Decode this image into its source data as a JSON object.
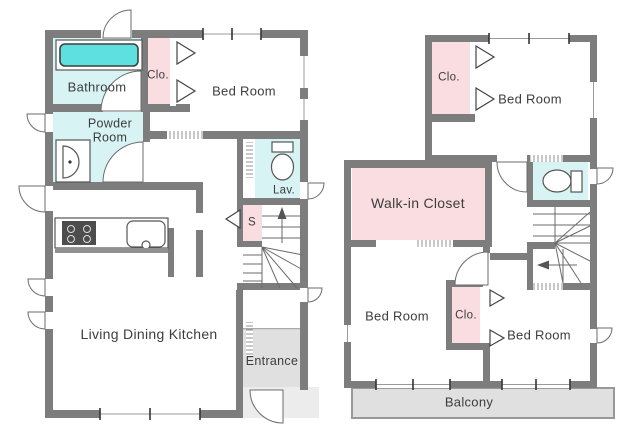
{
  "colors": {
    "wall": "#7d7d7d",
    "aqua": "#d8f3f3",
    "tub": "#5fe0e0",
    "pink": "#f9dde1",
    "roomgray": "#e0e0e0",
    "porchgray": "#ececec",
    "text": "#3d3d3d"
  },
  "floor1": {
    "rooms": {
      "bathroom": "Bathroom",
      "closet": "Clo.",
      "bedroom": "Bed Room",
      "powder_room": "Powder Room",
      "lavatory": "Lav.",
      "storage": "S",
      "living_dining_kitchen": "Living Dining Kitchen",
      "entrance": "Entrance"
    }
  },
  "floor2": {
    "rooms": {
      "closet_top": "Clo.",
      "bedroom_top": "Bed Room",
      "walk_in_closet": "Walk-in Closet",
      "bedroom_left": "Bed Room",
      "closet_middle": "Clo.",
      "bedroom_right": "Bed Room",
      "balcony": "Balcony"
    }
  }
}
